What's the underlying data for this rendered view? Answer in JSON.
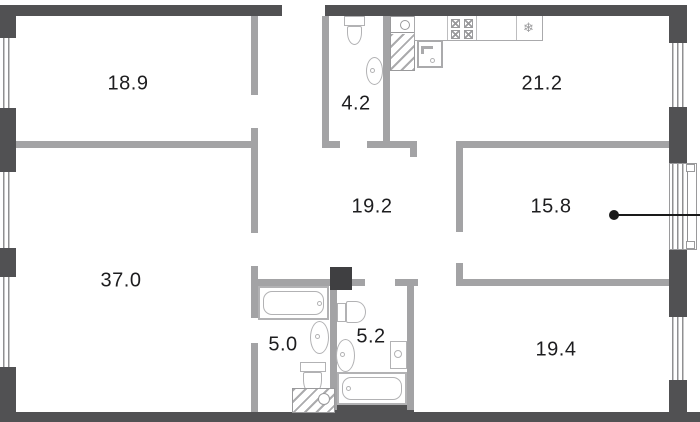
{
  "plan": {
    "title": "apartment-floor-plan",
    "rooms": [
      {
        "name": "bedroom-1",
        "area": "18.9"
      },
      {
        "name": "bathroom-top",
        "area": "4.2"
      },
      {
        "name": "kitchen",
        "area": "21.2"
      },
      {
        "name": "hallway",
        "area": "19.2"
      },
      {
        "name": "bedroom-2",
        "area": "15.8"
      },
      {
        "name": "living-room",
        "area": "37.0"
      },
      {
        "name": "bathroom-left",
        "area": "5.0"
      },
      {
        "name": "bathroom-right",
        "area": "5.2"
      },
      {
        "name": "bedroom-3",
        "area": "19.4"
      }
    ],
    "icons": {
      "fridge_snowflake": "❄"
    },
    "colors": {
      "exterior_wall": "#515153",
      "interior_wall": "#a3a3a5",
      "fixture": "#b2b2b4",
      "shaft_fill": "#3f3f41",
      "label": "#1d1d1f",
      "leader": "#1a1a1a",
      "background": "#ffffff"
    }
  }
}
